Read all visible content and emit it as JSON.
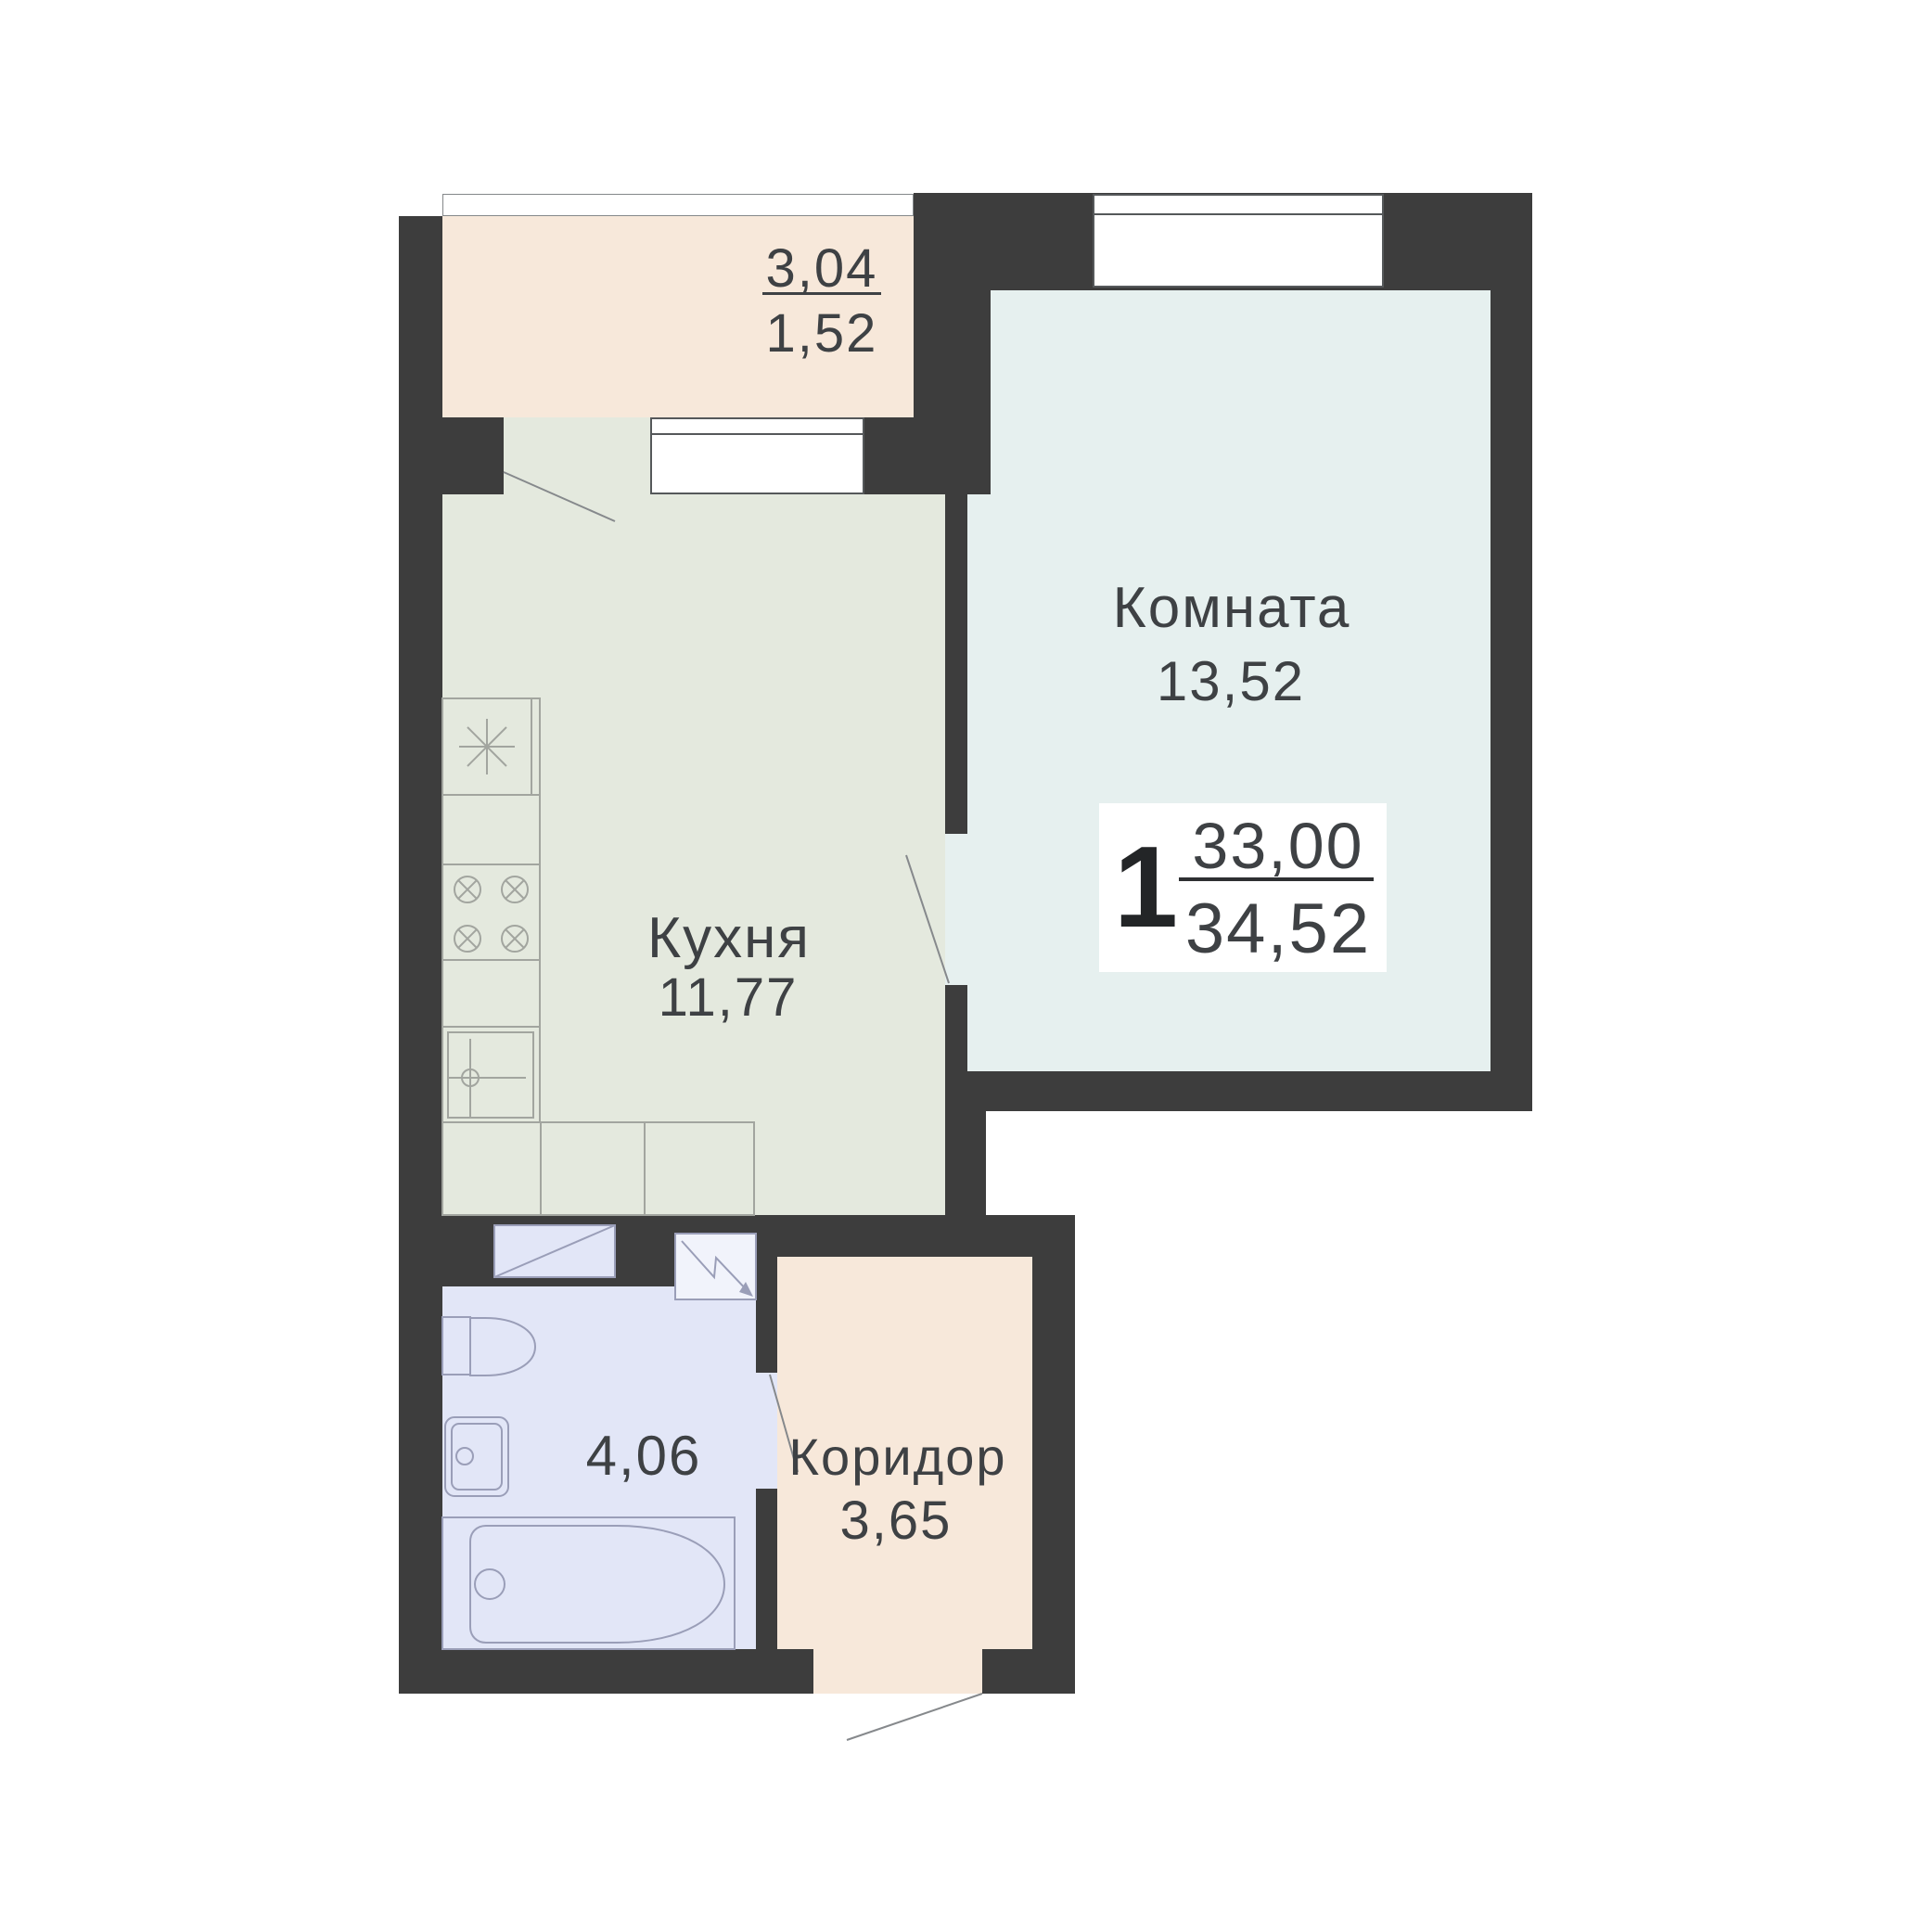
{
  "theme": {
    "wall": "#3d3d3d",
    "balcony": "#f7e8da",
    "kitchen": "#e4e9de",
    "room": "#e6f0ef",
    "bath": "#e2e6f7",
    "corridor": "#f7e8da",
    "text": "#3e4144",
    "winborder": "#55585a",
    "glzborder": "#84888a",
    "fixk": "#a2a59f",
    "fixb": "#9a9eb8",
    "door": "#86898c"
  },
  "plan": {
    "type": "apartment-floor-plan",
    "labels": {
      "balcony_area_upper": "3,04",
      "balcony_area_lower": "1,52",
      "room_name": "Комната",
      "room_area": "13,52",
      "kitchen_name": "Кухня",
      "kitchen_area": "11,77",
      "bathroom_area": "4,06",
      "corridor_name": "Коридор",
      "corridor_area": "3,65"
    },
    "summary": {
      "rooms_count": "1",
      "living_area": "33,00",
      "total_area": "34,52"
    },
    "fixtures": [
      "kitchen-counter",
      "star-appliance-icon",
      "cooktop-burners-icon",
      "kitchen-sink-icon",
      "washing-machine-icon",
      "shower-tray-icon",
      "toilet-icon",
      "washbasin-icon",
      "bathtub-icon",
      "balcony-door-swing",
      "room-door-swing",
      "bathroom-door-swing",
      "entrance-door-swing",
      "balcony-glazing",
      "kitchen-window",
      "room-window"
    ]
  }
}
